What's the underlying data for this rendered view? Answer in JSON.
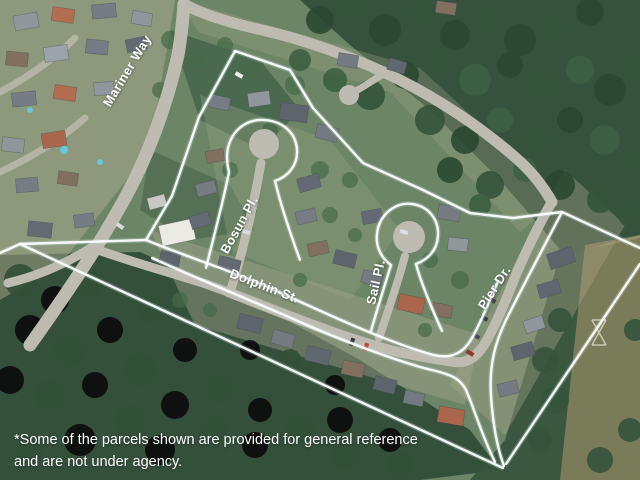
{
  "image": {
    "kind": "aerial-photo-with-parcel-outlines",
    "width": 640,
    "height": 480
  },
  "street_labels": [
    {
      "id": "mariner-way",
      "text": "Mariner Way"
    },
    {
      "id": "bosun-pl",
      "text": "Bosun Pl."
    },
    {
      "id": "dolphin-st",
      "text": "Dolphin St."
    },
    {
      "id": "sail-pl",
      "text": "Sail Pl."
    },
    {
      "id": "pier-dr",
      "text": "Pier Dr."
    }
  ],
  "disclaimer": {
    "line1": "*Some of the parcels shown are provided for general reference",
    "line2": "and are not under agency."
  },
  "colors": {
    "boundary": "#ffffff",
    "boundary_glow": "#c4e4da",
    "label_text": "#ffffff",
    "disclaimer_text": "#ffffff",
    "road": "#bdb9ae",
    "forest_dark": "#2a4530",
    "forest_mid": "#35593a"
  }
}
